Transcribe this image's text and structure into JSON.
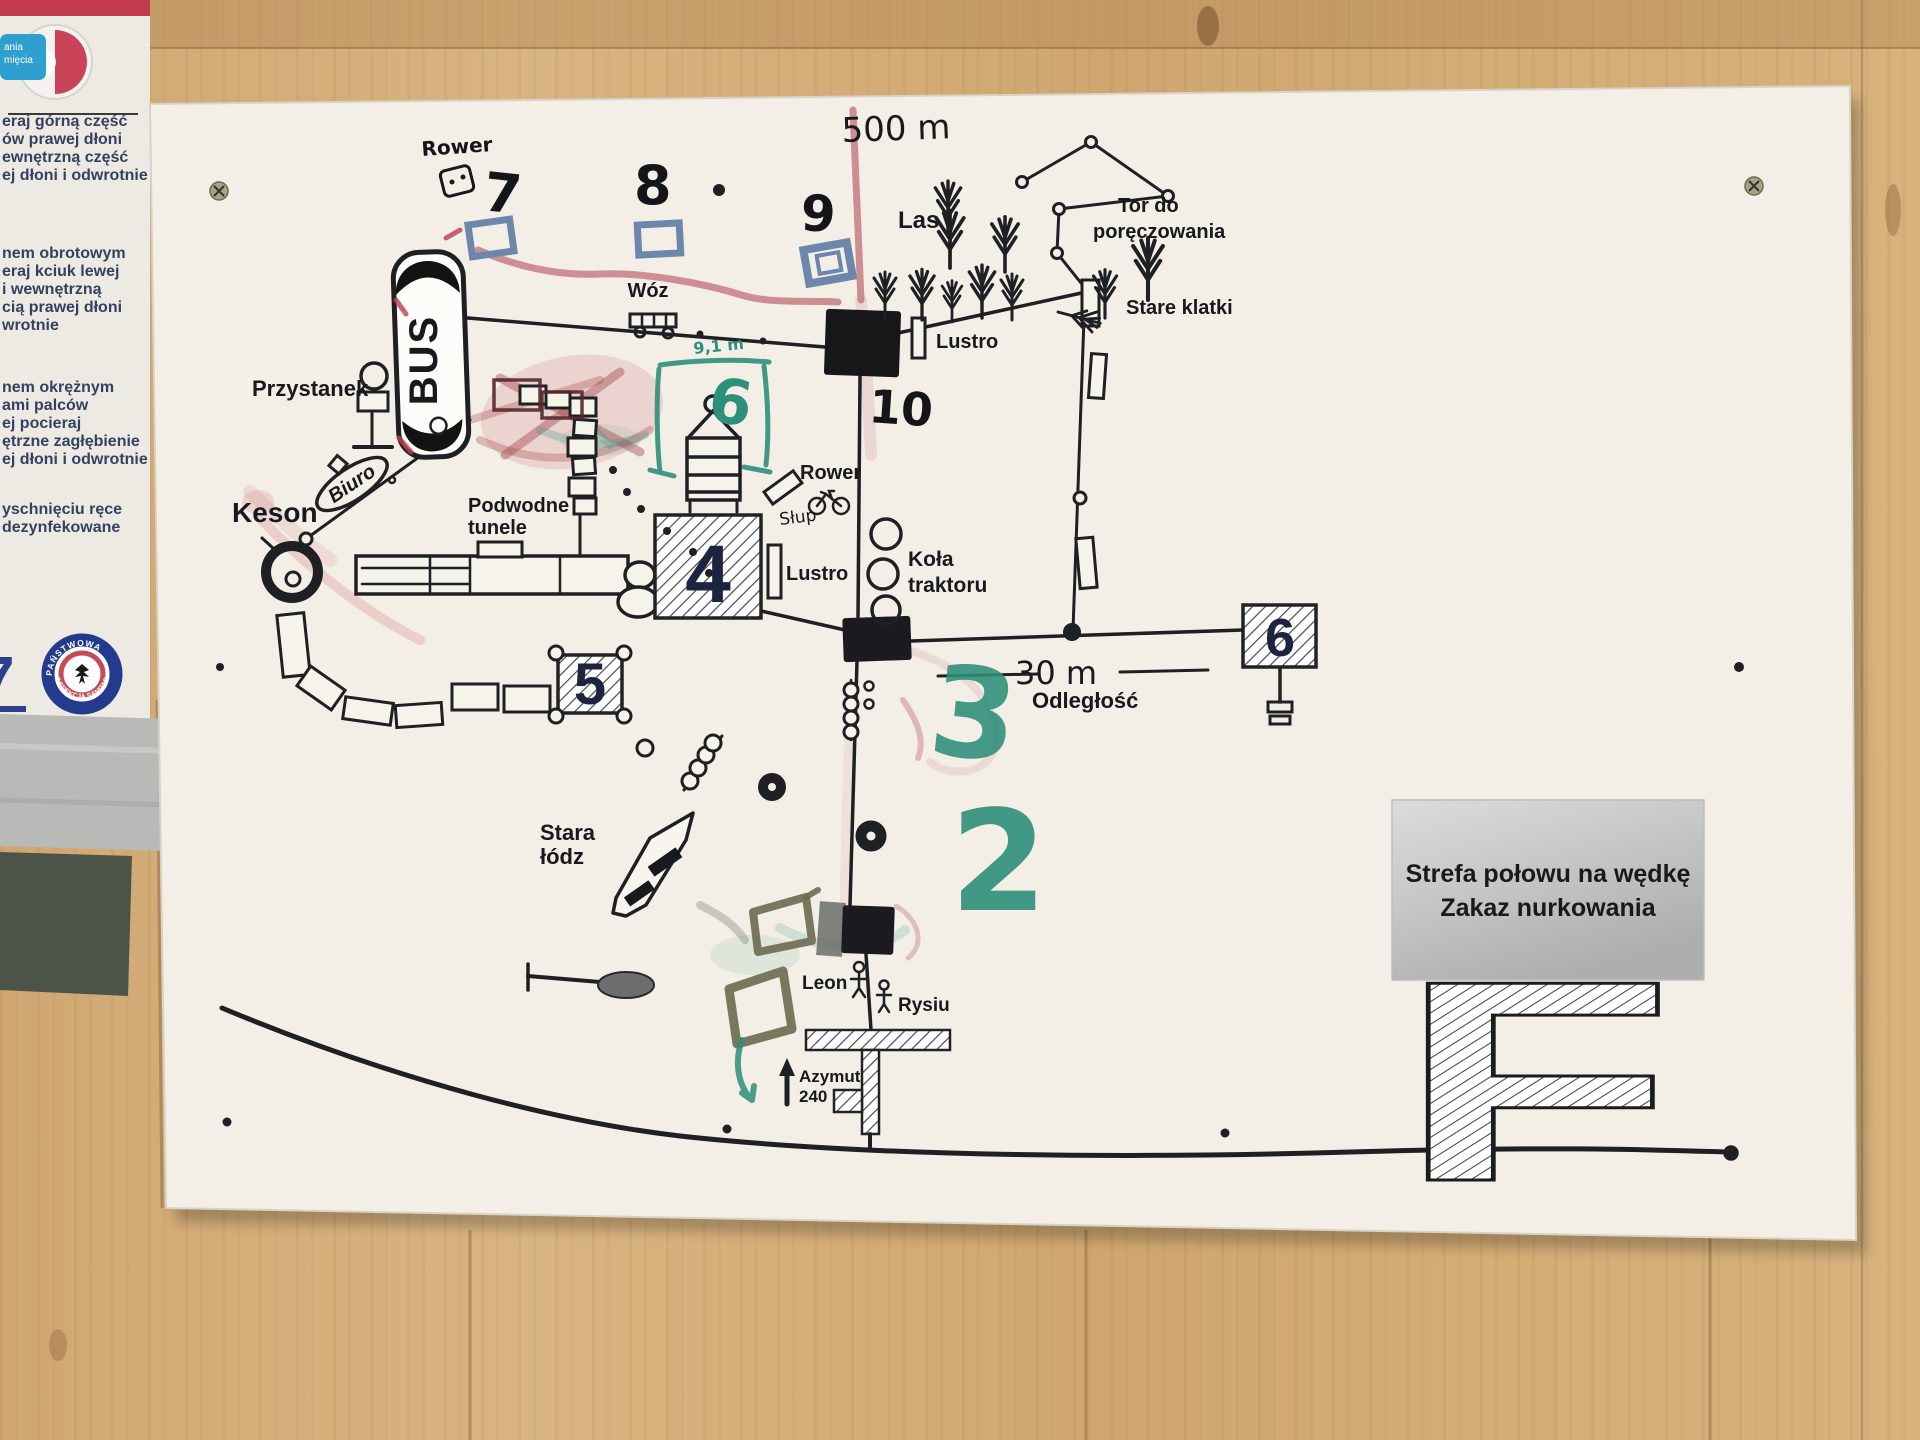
{
  "poster": {
    "badge_lines": [
      "ania",
      "mięcia"
    ],
    "block1": [
      "eraj górną część",
      "ów prawej dłoni",
      "ewnętrzną część",
      "ej dłoni i odwrotnie"
    ],
    "block2": [
      "nem obrotowym",
      "eraj kciuk lewej",
      "i wewnętrzną",
      "cią prawej dłoni",
      "wrotnie"
    ],
    "block3": [
      "nem okrężnym",
      "ami palców",
      "ej pocieraj",
      "ętrzne zagłębienie",
      "ej dłoni i odwrotnie"
    ],
    "block4": [
      "yschnięciu ręce",
      "dezynfekowane"
    ],
    "big_number": "7",
    "small_fragment": "wia",
    "logo_arc_top": "PAŃSTWOWA",
    "logo_arc_bottom": "INSPEKCJA SANITARNA"
  },
  "map": {
    "distance_500": "500 m",
    "forest": "Las",
    "rope_course_line1": "Tor do",
    "rope_course_line2": "poręczowania",
    "old_cages": "Stare klatki",
    "rower_handwritten": "Rower",
    "num7": "7",
    "num8": "8",
    "num9": "9",
    "num10": "10",
    "cart": "Wóz",
    "mirror_top": "Lustro",
    "mirror_mid": "Lustro",
    "bus": "BUS",
    "bus_stop": "Przystanek",
    "office": "Biuro",
    "caisson": "Keson",
    "tunnels_line1": "Podwodne",
    "tunnels_line2": "tunele",
    "bike": "Rower",
    "pole": "Słup",
    "wheels_line1": "Koła",
    "wheels_line2": "traktoru",
    "box4": "4",
    "box5": "5",
    "box6": "6",
    "green6": "6",
    "green_depth": "9,1 m",
    "green3": "3",
    "green2": "2",
    "distance_30": "30 m",
    "distance_label": "Odległość",
    "old_boat_line1": "Stara",
    "old_boat_line2": "łódz",
    "name1": "Leon",
    "name2": "Rysiu",
    "azimuth_line1": "Azymut",
    "azimuth_line2": "240",
    "zone_line1": "Strefa połowu na wędkę",
    "zone_line2": "Zakaz nurkowania",
    "letter_f": "F"
  },
  "colors": {
    "marker_teal": "#2e8f7b",
    "marker_red": "#c4767e",
    "print_navy": "#1d2440",
    "blue_pencil": "#6d86ac"
  }
}
